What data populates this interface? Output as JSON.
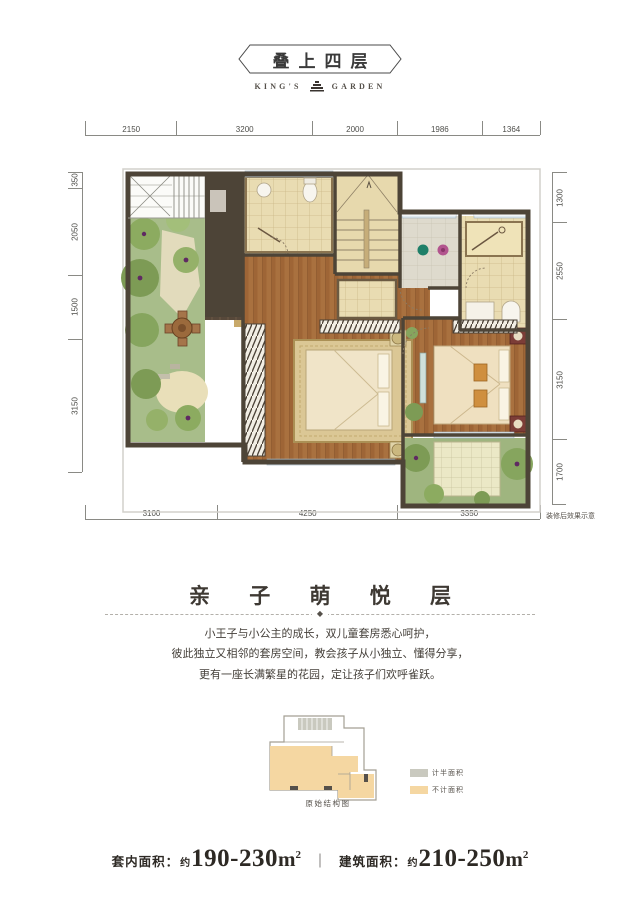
{
  "header": {
    "title": "叠上四层",
    "brand_left": "KING'S",
    "brand_right": "GARDEN"
  },
  "plan": {
    "dimensions": {
      "top": [
        "2150",
        "3200",
        "2000",
        "1986",
        "1364"
      ],
      "left": [
        "350",
        "2050",
        "1500",
        "3150"
      ],
      "right": [
        "1300",
        "2550",
        "3150",
        "1700"
      ],
      "bottom": [
        "3100",
        "4250",
        "3350"
      ]
    },
    "note": "装修后效果示意"
  },
  "section": {
    "title": "亲 子 萌 悦 层",
    "divider_glyph": "◆",
    "paragraph": [
      "小王子与小公主的成长，双儿童套房悉心呵护，",
      "彼此独立又相邻的套房空间，教会孩子从小独立、懂得分享，",
      "更有一座长满繁星的花园，定让孩子们欢呼雀跃。"
    ]
  },
  "mini_diagram": {
    "legend": [
      {
        "label": "计半面积",
        "color": "#c9c9bf"
      },
      {
        "label": "不计面积",
        "color": "#f5d7a2"
      }
    ],
    "caption": "原始结构图"
  },
  "footer": {
    "label1": "套内面积：",
    "approx1": "约",
    "value1": "190-230",
    "unit1": "m",
    "sup1": "2",
    "sep": "｜",
    "label2": "建筑面积：",
    "approx2": "约",
    "value2": "210-250",
    "unit2": "m",
    "sup2": "2"
  }
}
